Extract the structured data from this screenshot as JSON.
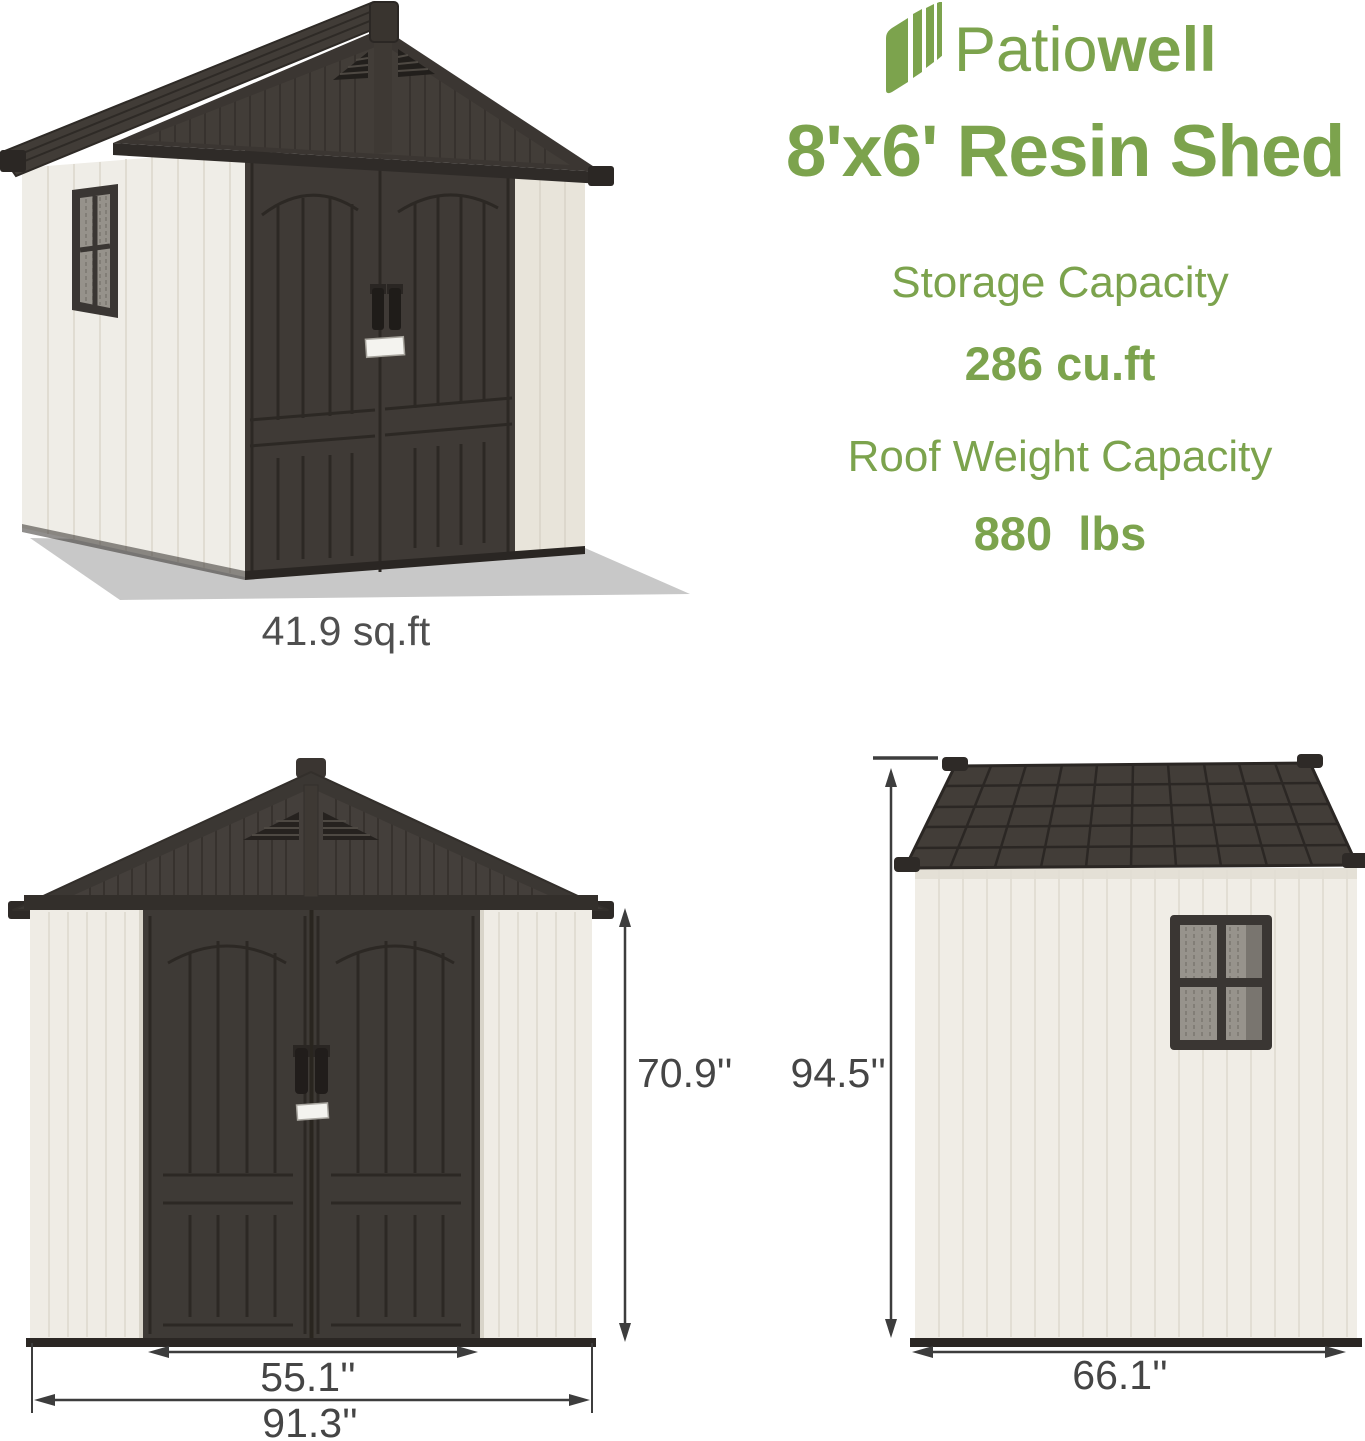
{
  "brand": {
    "logo": {
      "icon": "patiowell-pages-icon",
      "regular": "Patio",
      "bold": "well"
    },
    "title": "8'x6' Resin Shed"
  },
  "specs": [
    {
      "label": "Storage Capacity",
      "value": "286 cu.ft"
    },
    {
      "label": "Roof Weight Capacity",
      "value": "880  lbs"
    }
  ],
  "views": {
    "perspective": {
      "caption": "41.9 sq.ft"
    },
    "front": {
      "height_label": "70.9''",
      "door_width_label": "55.1''",
      "overall_width_label": "91.3''"
    },
    "side": {
      "height_label": "94.5''",
      "depth_label": "66.1''"
    }
  },
  "colors": {
    "accent_green": "#7CA34D",
    "dimension_gray": "#454545",
    "roof_dark": "#3B3733",
    "door_dark": "#3E3A36",
    "wall_cream": "#EFECE5",
    "ground_shadow": "#C8C8C8"
  }
}
